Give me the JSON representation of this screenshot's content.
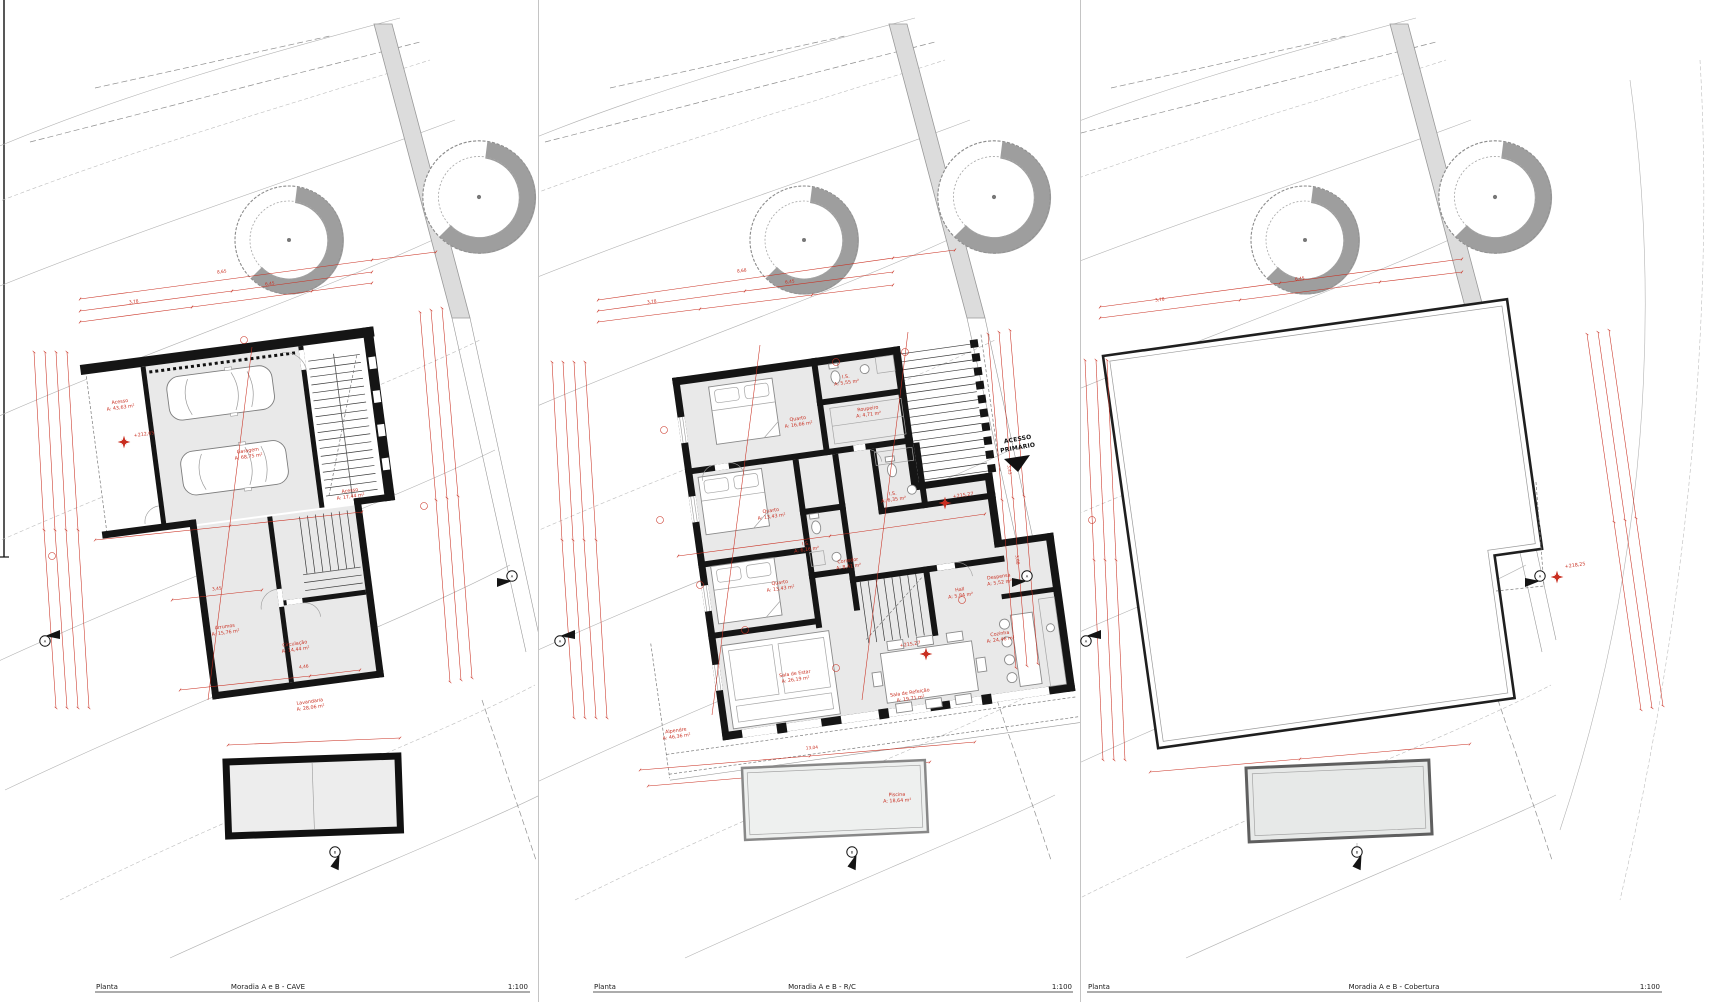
{
  "footer": {
    "label": "Planta",
    "scale": "1:100"
  },
  "colors": {
    "dimension_red": "#c92f21",
    "wall_black": "#151515",
    "room_fill": "#e9e9e9"
  },
  "markers": {
    "side_letter": "A",
    "bottom_letter": "B"
  },
  "panels": {
    "cave": {
      "title": "Moradia A e B - CAVE",
      "level": "+212,65",
      "rooms": [
        {
          "name": "Acesso",
          "area": "A: 43,63 m²"
        },
        {
          "name": "Garagem",
          "area": "A: 68,75 m²"
        },
        {
          "name": "Acesso",
          "area": "A: 17,44 m²"
        },
        {
          "name": "Arrumos",
          "area": "A: 15,76 m²"
        },
        {
          "name": "Circulação",
          "area": "A: 14,44 m²"
        },
        {
          "name": "Lavandaria",
          "area": "A: 28,06 m²"
        }
      ]
    },
    "rc": {
      "title": "Moradia A e B - R/C",
      "levels": [
        "+215,27",
        "+215,27"
      ],
      "access_label_line1": "ACESSO",
      "access_label_line2": "PRIMÁRIO",
      "rooms": [
        {
          "name": "Quarto",
          "area": "A: 16,66 m²"
        },
        {
          "name": "I.S.",
          "area": "A: 5,55 m²"
        },
        {
          "name": "Roupeiro",
          "area": "A: 4,71 m²"
        },
        {
          "name": "Quarto",
          "area": "A: 13,43 m²"
        },
        {
          "name": "I.S.",
          "area": "A: 6,16 m²"
        },
        {
          "name": "I.S.",
          "area": "A: 6,35 m²"
        },
        {
          "name": "Quarto",
          "area": "A: 13,43 m²"
        },
        {
          "name": "Corredor",
          "area": "A: 8,41 m²"
        },
        {
          "name": "Hall",
          "area": "A: 5,84 m²"
        },
        {
          "name": "Despensa",
          "area": "A: 5,52 m²"
        },
        {
          "name": "Cozinha",
          "area": "A: 24,46 m²"
        },
        {
          "name": "Sala de Estar",
          "area": "A: 26,19 m²"
        },
        {
          "name": "Sala de Refeição",
          "area": "A: 19,71 m²"
        },
        {
          "name": "Alpendre",
          "area": "A: 46,36 m²"
        },
        {
          "name": "Piscina",
          "area": "A: 18,64 m²"
        }
      ]
    },
    "cobertura": {
      "title": "Moradia A e B - Cobertura",
      "level": "+218,25"
    }
  },
  "dims": {
    "cave": {
      "top": [
        "3,78",
        "6,45",
        "8,65"
      ],
      "inner": "3,45",
      "bottom": "4,46"
    },
    "rc": {
      "top": [
        "3,78",
        "6,45",
        "8,68"
      ],
      "right": [
        "3,43",
        "3,68"
      ],
      "bottom": "13,04"
    },
    "cobertura": {
      "top": [
        "3,78",
        "6,45"
      ]
    }
  }
}
